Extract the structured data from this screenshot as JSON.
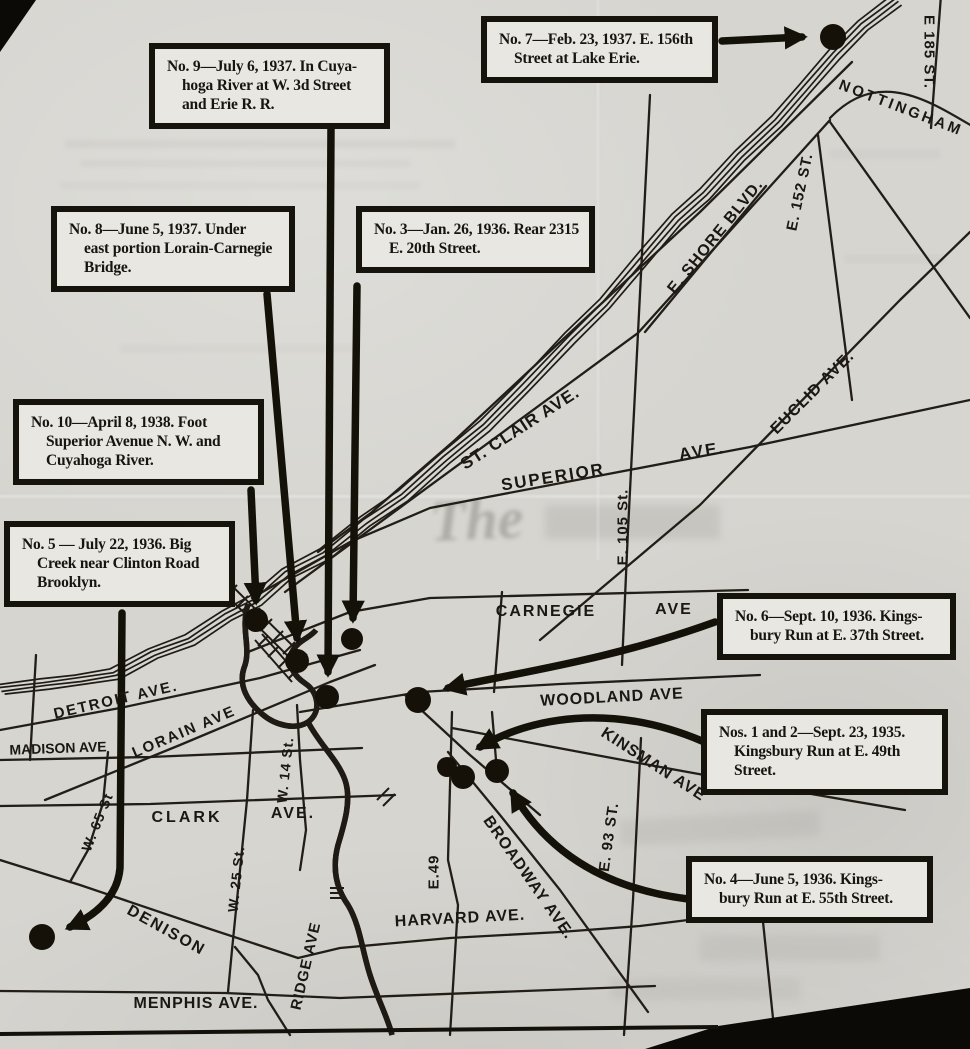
{
  "colors": {
    "paper": "#d6d5d0",
    "ink": "#17130d",
    "box_bg": "#e8e7e1"
  },
  "ghost": {
    "masthead": "The"
  },
  "callouts": [
    {
      "id": "no-9",
      "box": {
        "x": 149,
        "y": 43,
        "w": 241
      },
      "lines": [
        "No. 9—July 6, 1937.  In Cuya-",
        "hoga River at W. 3d Street",
        "and Erie R. R."
      ]
    },
    {
      "id": "no-7",
      "box": {
        "x": 481,
        "y": 16,
        "w": 237
      },
      "lines": [
        "No. 7—Feb. 23, 1937.  E. 156th",
        "Street at Lake Erie."
      ]
    },
    {
      "id": "no-8",
      "box": {
        "x": 51,
        "y": 206,
        "w": 244
      },
      "lines": [
        "No. 8—June 5, 1937.  Under",
        "east portion Lorain-Carnegie",
        "Bridge."
      ]
    },
    {
      "id": "no-3",
      "box": {
        "x": 356,
        "y": 206,
        "w": 239
      },
      "lines": [
        "No. 3—Jan. 26, 1936. Rear 2315",
        "E. 20th Street."
      ]
    },
    {
      "id": "no-10",
      "box": {
        "x": 13,
        "y": 399,
        "w": 251
      },
      "lines": [
        "No. 10—April 8, 1938.  Foot",
        "Superior Avenue N. W. and",
        "Cuyahoga River."
      ]
    },
    {
      "id": "no-5",
      "box": {
        "x": 4,
        "y": 521,
        "w": 231
      },
      "lines": [
        "No. 5 — July 22, 1936.  Big",
        "Creek near Clinton Road",
        "Brooklyn."
      ]
    },
    {
      "id": "no-6",
      "box": {
        "x": 717,
        "y": 593,
        "w": 239
      },
      "lines": [
        "No. 6—Sept. 10, 1936.  Kings-",
        "bury Run at E. 37th Street."
      ]
    },
    {
      "id": "nos-1-and-2",
      "box": {
        "x": 701,
        "y": 709,
        "w": 247
      },
      "lines": [
        "Nos. 1 and 2—Sept. 23, 1935.",
        "Kingsbury Run at E. 49th",
        "Street."
      ]
    },
    {
      "id": "no-4",
      "box": {
        "x": 686,
        "y": 856,
        "w": 247
      },
      "lines": [
        "No. 4—June 5, 1936.  Kings-",
        "bury Run at E. 55th Street."
      ]
    }
  ],
  "street_labels": [
    {
      "text": "E 185 ST.",
      "x": 929,
      "y": 52,
      "rot": 90,
      "size": 15,
      "ls": 1
    },
    {
      "text": "NOTTINGHAM",
      "x": 901,
      "y": 108,
      "rot": 21,
      "size": 15,
      "ls": 3
    },
    {
      "text": "E. SHORE BLVD.",
      "x": 716,
      "y": 237,
      "rot": -51,
      "size": 16,
      "ls": 1
    },
    {
      "text": "E. 152 ST.",
      "x": 800,
      "y": 192,
      "rot": -78,
      "size": 15,
      "ls": 1
    },
    {
      "text": "EUCLID AVE.",
      "x": 813,
      "y": 393,
      "rot": -45,
      "size": 16,
      "ls": 1
    },
    {
      "text": "ST. CLAIR AVE.",
      "x": 520,
      "y": 428,
      "rot": -33,
      "size": 17,
      "ls": 1
    },
    {
      "text": "SUPERIOR",
      "x": 553,
      "y": 477,
      "rot": -9,
      "size": 17,
      "ls": 2
    },
    {
      "text": "AVE.",
      "x": 702,
      "y": 451,
      "rot": -9,
      "size": 17,
      "ls": 2
    },
    {
      "text": "E. 105 St.",
      "x": 623,
      "y": 527,
      "rot": -90,
      "size": 15,
      "ls": 1
    },
    {
      "text": "CARNEGIE",
      "x": 546,
      "y": 612,
      "rot": 0,
      "size": 16,
      "ls": 2
    },
    {
      "text": "AVE",
      "x": 674,
      "y": 610,
      "rot": 0,
      "size": 16,
      "ls": 2
    },
    {
      "text": "WOODLAND AVE",
      "x": 612,
      "y": 698,
      "rot": -3,
      "size": 16,
      "ls": 1
    },
    {
      "text": "KINSMAN AVE",
      "x": 653,
      "y": 765,
      "rot": 33,
      "size": 16,
      "ls": 1
    },
    {
      "text": "BROADWAY AVE.",
      "x": 528,
      "y": 878,
      "rot": 55,
      "size": 16,
      "ls": 1
    },
    {
      "text": "E. 93 ST.",
      "x": 609,
      "y": 837,
      "rot": -82,
      "size": 15,
      "ls": 1
    },
    {
      "text": "E.49",
      "x": 434,
      "y": 872,
      "rot": -90,
      "size": 15,
      "ls": 1
    },
    {
      "text": "HARVARD AVE.",
      "x": 460,
      "y": 919,
      "rot": -3,
      "size": 16,
      "ls": 1
    },
    {
      "text": "MENPHIS AVE.",
      "x": 196,
      "y": 1004,
      "rot": 0,
      "size": 16,
      "ls": 1
    },
    {
      "text": "RIDGE AVE",
      "x": 306,
      "y": 966,
      "rot": -77,
      "size": 15,
      "ls": 1
    },
    {
      "text": "DENISON",
      "x": 166,
      "y": 931,
      "rot": 29,
      "size": 16,
      "ls": 2
    },
    {
      "text": "W. 65 St",
      "x": 97,
      "y": 822,
      "rot": -68,
      "size": 14,
      "ls": 1
    },
    {
      "text": "W. 25 St.",
      "x": 236,
      "y": 879,
      "rot": -84,
      "size": 14,
      "ls": 1
    },
    {
      "text": "W. 14 St.",
      "x": 285,
      "y": 770,
      "rot": -84,
      "size": 14,
      "ls": 1
    },
    {
      "text": "CLARK",
      "x": 187,
      "y": 818,
      "rot": 0,
      "size": 16,
      "ls": 3
    },
    {
      "text": "AVE.",
      "x": 293,
      "y": 814,
      "rot": 0,
      "size": 16,
      "ls": 2
    },
    {
      "text": "MADISON AVE",
      "x": 58,
      "y": 748,
      "rot": -2,
      "size": 14,
      "ls": 0
    },
    {
      "text": "LORAIN AVE",
      "x": 184,
      "y": 732,
      "rot": -23,
      "size": 15,
      "ls": 2
    },
    {
      "text": "DETROIT AVE.",
      "x": 116,
      "y": 700,
      "rot": -13,
      "size": 15,
      "ls": 2
    }
  ],
  "markers": [
    {
      "id": "dot-no-7",
      "x": 833,
      "y": 37,
      "r": 13
    },
    {
      "id": "dot-no-10",
      "x": 256,
      "y": 620,
      "r": 12
    },
    {
      "id": "dot-no-8",
      "x": 297,
      "y": 661,
      "r": 12
    },
    {
      "id": "dot-no-9",
      "x": 327,
      "y": 697,
      "r": 12
    },
    {
      "id": "dot-no-3",
      "x": 352,
      "y": 639,
      "r": 11
    },
    {
      "id": "dot-no-6",
      "x": 418,
      "y": 700,
      "r": 13
    },
    {
      "id": "dot-no-1",
      "x": 447,
      "y": 767,
      "r": 10
    },
    {
      "id": "dot-no-2",
      "x": 463,
      "y": 777,
      "r": 12
    },
    {
      "id": "dot-no-4",
      "x": 497,
      "y": 771,
      "r": 12
    },
    {
      "id": "dot-no-5",
      "x": 42,
      "y": 937,
      "r": 13
    }
  ]
}
